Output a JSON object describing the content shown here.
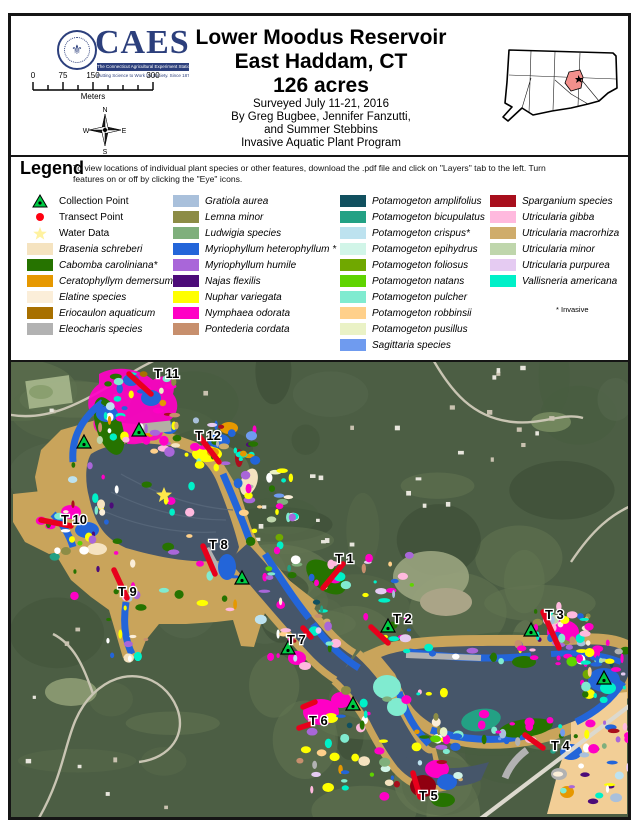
{
  "header": {
    "logo": {
      "acronym": "CAES",
      "tagline1": "The Connecticut Agricultural Experiment Station",
      "tagline2": "Putting Science to Work for Society. Since 1875"
    },
    "scale_bar": {
      "ticks": [
        "0",
        "75",
        "150",
        "300"
      ],
      "unit": "Meters"
    },
    "compass": {
      "n": "N",
      "s": "S",
      "e": "E",
      "w": "W"
    },
    "title": {
      "line1": "Lower Moodus Reservoir",
      "line2": "East Haddam, CT",
      "line3": "126 acres",
      "surveyed": "Surveyed July 11-21, 2016",
      "by1": "By Greg Bugbee, Jennifer Fanzutti,",
      "by2": "and Summer Stebbins",
      "program": "Invasive Aquatic Plant Program"
    },
    "inset": {
      "highlight_color": "#F2908C",
      "outline_color": "#000000"
    }
  },
  "legend": {
    "heading": "Legend",
    "description_line1": "To view locations of individual plant species or other features, download the .pdf file and click on \"Layers\" tab to the left. Turn",
    "description_line2": "features on or off by clicking the \"Eye\" icons.",
    "invasive_note": "* Invasive",
    "points": [
      {
        "label": "Collection Point",
        "symbol": "collection-triangle",
        "color": "#00CC44"
      },
      {
        "label": "Transect Point",
        "symbol": "transect-dot",
        "color": "#FF0010"
      },
      {
        "label": "Water Data",
        "symbol": "water-star",
        "color": "#FFF2A0"
      }
    ],
    "species_col1": [
      {
        "label": "Brasenia schreberi",
        "color": "#F5E3C0"
      },
      {
        "label": "Cabomba caroliniana*",
        "color": "#267300"
      },
      {
        "label": "Ceratophyllym demersum",
        "color": "#E69800"
      },
      {
        "label": "Elatine species",
        "color": "#FBEED9"
      },
      {
        "label": "Eriocaulon aquaticum",
        "color": "#A87000"
      },
      {
        "label": "Eleocharis species",
        "color": "#B2B2B2"
      }
    ],
    "species_col2": [
      {
        "label": "Gratiola aurea",
        "color": "#A9C0DB"
      },
      {
        "label": "Lemna minor",
        "color": "#8C8C46"
      },
      {
        "label": "Ludwigia species",
        "color": "#7FAF7C"
      },
      {
        "label": "Myriophyllum heterophyllum *",
        "color": "#2365D9"
      },
      {
        "label": "Myriophyllum humile",
        "color": "#A966D9"
      },
      {
        "label": "Najas flexilis",
        "color": "#4C0B79"
      },
      {
        "label": "Nuphar variegata",
        "color": "#FFFF00"
      },
      {
        "label": "Nymphaea odorata",
        "color": "#FF00C5"
      },
      {
        "label": "Pontederia cordata",
        "color": "#C78F6D"
      }
    ],
    "species_col3": [
      {
        "label": "Potamogeton amplifolius",
        "color": "#11505F"
      },
      {
        "label": "Potamogeton bicupulatus",
        "color": "#23A184"
      },
      {
        "label": "Potamogeton crispus*",
        "color": "#BDE2EF"
      },
      {
        "label": "Potamogeton epihydrus",
        "color": "#D1F5E8"
      },
      {
        "label": "Potamogeton foliosus",
        "color": "#70A800"
      },
      {
        "label": "Potamogeton natans",
        "color": "#5FD400"
      },
      {
        "label": "Potamogeton pulcher",
        "color": "#80EBD0"
      },
      {
        "label": "Potamogeton robbinsii",
        "color": "#FFD08A"
      },
      {
        "label": "Potamogeton pusillus",
        "color": "#EAF2C6"
      },
      {
        "label": "Sagittaria species",
        "color": "#6F9BEF"
      }
    ],
    "species_col4": [
      {
        "label": "Sparganium species",
        "color": "#A80E1C"
      },
      {
        "label": "Utricularia gibba",
        "color": "#FFB9DE"
      },
      {
        "label": "Utricularia macrorhiza",
        "color": "#CFAC6B"
      },
      {
        "label": "Utricularia minor",
        "color": "#BFD6AC"
      },
      {
        "label": "Utricularia purpurea",
        "color": "#E5CBF2"
      },
      {
        "label": "Vallisneria americana",
        "color": "#00F0C8"
      }
    ]
  },
  "map": {
    "terrain_color": "#4C5E44",
    "water_color": "#46566A",
    "shallow_color": "#C9A45B",
    "labels": [
      {
        "text": "T 1",
        "x": 324,
        "y": 201
      },
      {
        "text": "T 2",
        "x": 382,
        "y": 261
      },
      {
        "text": "T 3",
        "x": 534,
        "y": 257
      },
      {
        "text": "T 4",
        "x": 540,
        "y": 388
      },
      {
        "text": "T 5",
        "x": 408,
        "y": 438
      },
      {
        "text": "T 6",
        "x": 298,
        "y": 363
      },
      {
        "text": "T 7",
        "x": 276,
        "y": 282
      },
      {
        "text": "T 8",
        "x": 198,
        "y": 187
      },
      {
        "text": "T 9",
        "x": 107,
        "y": 234
      },
      {
        "text": "T 10",
        "x": 50,
        "y": 162
      },
      {
        "text": "T 11",
        "x": 143,
        "y": 16
      },
      {
        "text": "T 12",
        "x": 184,
        "y": 78
      }
    ],
    "collection_points": [
      [
        73,
        80
      ],
      [
        128,
        68
      ],
      [
        231,
        216
      ],
      [
        377,
        264
      ],
      [
        277,
        286
      ],
      [
        342,
        342
      ],
      [
        520,
        268
      ],
      [
        593,
        316
      ]
    ],
    "transects": [
      [
        118,
        12,
        140,
        32
      ],
      [
        188,
        74,
        208,
        100
      ],
      [
        30,
        158,
        60,
        164
      ],
      [
        192,
        184,
        204,
        212
      ],
      [
        103,
        208,
        116,
        236
      ],
      [
        332,
        202,
        312,
        226
      ],
      [
        360,
        265,
        377,
        281
      ],
      [
        532,
        250,
        548,
        286
      ],
      [
        292,
        266,
        300,
        275
      ],
      [
        292,
        345,
        304,
        340
      ],
      [
        288,
        366,
        300,
        362
      ],
      [
        402,
        411,
        409,
        435
      ],
      [
        514,
        373,
        532,
        386
      ]
    ],
    "water_star": [
      153,
      133
    ]
  }
}
